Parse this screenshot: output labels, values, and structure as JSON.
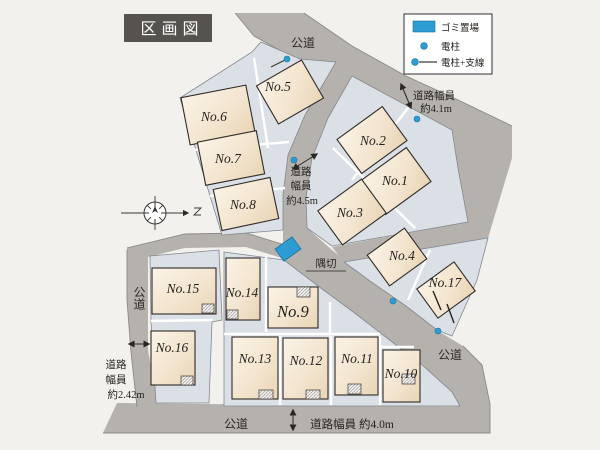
{
  "title": "区画図",
  "legend": {
    "items": [
      {
        "name": "trash-area",
        "label": "ゴミ置場"
      },
      {
        "name": "utility-pole",
        "label": "電柱"
      },
      {
        "name": "utility-pole-guy-wire",
        "label": "電柱+支線"
      }
    ]
  },
  "lots": [
    {
      "id": "No.1"
    },
    {
      "id": "No.2"
    },
    {
      "id": "No.3"
    },
    {
      "id": "No.4"
    },
    {
      "id": "No.5"
    },
    {
      "id": "No.6"
    },
    {
      "id": "No.7"
    },
    {
      "id": "No.8"
    },
    {
      "id": "No.9"
    },
    {
      "id": "No.10"
    },
    {
      "id": "No.11"
    },
    {
      "id": "No.12"
    },
    {
      "id": "No.13"
    },
    {
      "id": "No.14"
    },
    {
      "id": "No.15"
    },
    {
      "id": "No.16"
    },
    {
      "id": "No.17"
    }
  ],
  "roads": {
    "top": "公道",
    "left": "公道",
    "diagonal": "公道",
    "bottom": "公道"
  },
  "widths": {
    "w41": {
      "l1": "道路幅員",
      "l2": "約4.1m"
    },
    "w45": {
      "l1": "道路",
      "l2": "幅員",
      "l3": "約4.5m"
    },
    "w242": {
      "l1": "道路",
      "l2": "幅員",
      "l3": "約2.42m"
    },
    "w40": "道路幅員 約4.0m"
  },
  "corner_cut": "隅切",
  "colors": {
    "background": "#f2f1ee",
    "road": "#b5b1ad",
    "lot": "#dbe0e6",
    "house": "#f6ecdc",
    "accent_blue": "#2d9cd3",
    "title_bg": "#56524e"
  }
}
